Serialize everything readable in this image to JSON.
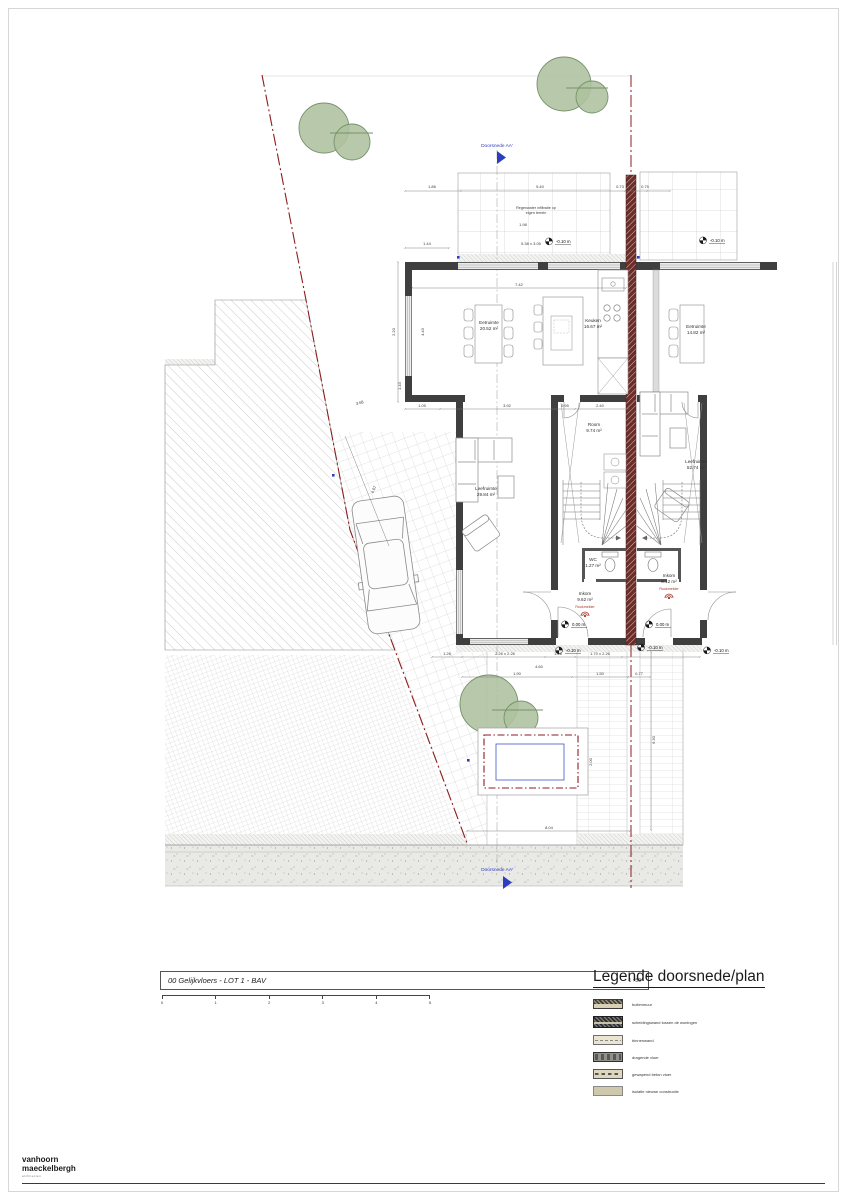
{
  "titleblock": {
    "title": "00 Gelijkvloers - LOT 1 - BAV",
    "scale": "1 : 50",
    "scale_ticks": [
      "0",
      "1",
      "2",
      "3",
      "4",
      "5"
    ]
  },
  "legend": {
    "title": "Legende doorsnede/plan",
    "items": [
      {
        "label": "buitenmuur",
        "cls": "s1"
      },
      {
        "label": "scheidingswand tussen de woningen",
        "cls": "s2"
      },
      {
        "label": "binnenwand",
        "cls": "s3"
      },
      {
        "label": "dragende vloer",
        "cls": "s4"
      },
      {
        "label": "gewapend beton vloer",
        "cls": "s5"
      },
      {
        "label": "isolatie nieuwe constructie",
        "cls": "s6"
      }
    ]
  },
  "logo": {
    "line1": "vanhoorn",
    "line2": "maeckelbergh",
    "sub": "architecten"
  },
  "colors": {
    "wall": "#3f3f3f",
    "party_wall": "#6c2d2a",
    "boundary": "#8c1d1d",
    "section_blue": "#2d3fc0",
    "tree": "#aec29f",
    "smoke_red": "#a8372c"
  },
  "plan": {
    "section_top": "Doorsnede AA'",
    "section_bottom": "Doorsnede AA'",
    "smoke_label": "Rookmelder",
    "rooms": [
      {
        "name": "Eetruimte",
        "area": "20.52 m²",
        "x": 489,
        "y": 324
      },
      {
        "name": "Keuken",
        "area": "16.67 m²",
        "x": 593,
        "y": 322
      },
      {
        "name": "Eetruimte",
        "area": "14.82 m²",
        "x": 696,
        "y": 328
      },
      {
        "name": "Room",
        "area": "9.74 m²",
        "x": 594,
        "y": 426
      },
      {
        "name": "Leefruimte",
        "area": "29.84 m²",
        "x": 486,
        "y": 490
      },
      {
        "name": "Leefruimte",
        "area": "52.74 m²",
        "x": 696,
        "y": 463
      },
      {
        "name": "WC",
        "area": "1.27 m²",
        "x": 593,
        "y": 561
      },
      {
        "name": "Inkom",
        "area": "9.62 m²",
        "x": 585,
        "y": 595
      },
      {
        "name": "Inkom",
        "area": "8.12 m²",
        "x": 669,
        "y": 577
      }
    ],
    "smoke": [
      {
        "x": 585,
        "y": 608
      },
      {
        "x": 669,
        "y": 590
      }
    ],
    "levels": [
      {
        "t": "0.00 m",
        "x": 572,
        "y": 626
      },
      {
        "t": "0.00 m",
        "x": 656,
        "y": 626
      },
      {
        "t": "-0.10 m",
        "x": 566,
        "y": 652
      },
      {
        "t": "-0.10 m",
        "x": 648,
        "y": 649
      },
      {
        "t": "-0.10 m",
        "x": 556,
        "y": 243
      },
      {
        "t": "-0.10 m",
        "x": 710,
        "y": 242
      },
      {
        "t": "-0.10 m",
        "x": 714,
        "y": 652
      }
    ],
    "notes": [
      {
        "t": "Regenwater infiltratie op",
        "x": 536,
        "y": 209
      },
      {
        "t": "eigen terrein",
        "x": 536,
        "y": 214
      }
    ],
    "dims": [
      {
        "t": "1.86",
        "x": 432,
        "y": 188
      },
      {
        "t": "5.40",
        "x": 540,
        "y": 188
      },
      {
        "t": "0.73",
        "x": 620,
        "y": 188
      },
      {
        "t": "0.75",
        "x": 645,
        "y": 188
      },
      {
        "t": "1.98",
        "x": 523,
        "y": 226
      },
      {
        "t": "1.44",
        "x": 427,
        "y": 245
      },
      {
        "t": "5.38 x 3.05",
        "x": 531,
        "y": 245
      },
      {
        "t": "7.42",
        "x": 519,
        "y": 286
      },
      {
        "t": "2.20",
        "x": 395,
        "y": 332,
        "r": -90
      },
      {
        "t": "4.43",
        "x": 424,
        "y": 332,
        "r": -90
      },
      {
        "t": "1.43",
        "x": 401,
        "y": 386,
        "r": -90
      },
      {
        "t": "1.05",
        "x": 422,
        "y": 407
      },
      {
        "t": "3.92",
        "x": 507,
        "y": 407
      },
      {
        "t": "0.95",
        "x": 565,
        "y": 407
      },
      {
        "t": "2.40",
        "x": 600,
        "y": 407
      },
      {
        "t": "3.68",
        "x": 360,
        "y": 404,
        "r": -14
      },
      {
        "t": "4.07",
        "x": 375,
        "y": 490,
        "r": -68
      },
      {
        "t": "1.26",
        "x": 447,
        "y": 655
      },
      {
        "t": "2.26 x 2.26",
        "x": 505,
        "y": 655
      },
      {
        "t": "1.26",
        "x": 558,
        "y": 655
      },
      {
        "t": "1.70 x 2.26",
        "x": 600,
        "y": 655
      },
      {
        "t": "4.60",
        "x": 539,
        "y": 668
      },
      {
        "t": "1.90",
        "x": 517,
        "y": 675
      },
      {
        "t": "1.50",
        "x": 600,
        "y": 675
      },
      {
        "t": "0.77",
        "x": 639,
        "y": 675
      },
      {
        "t": "8.04",
        "x": 549,
        "y": 829
      },
      {
        "t": "6.30",
        "x": 655,
        "y": 740,
        "r": -90
      },
      {
        "t": "2.00",
        "x": 592,
        "y": 762,
        "r": -90
      }
    ]
  }
}
